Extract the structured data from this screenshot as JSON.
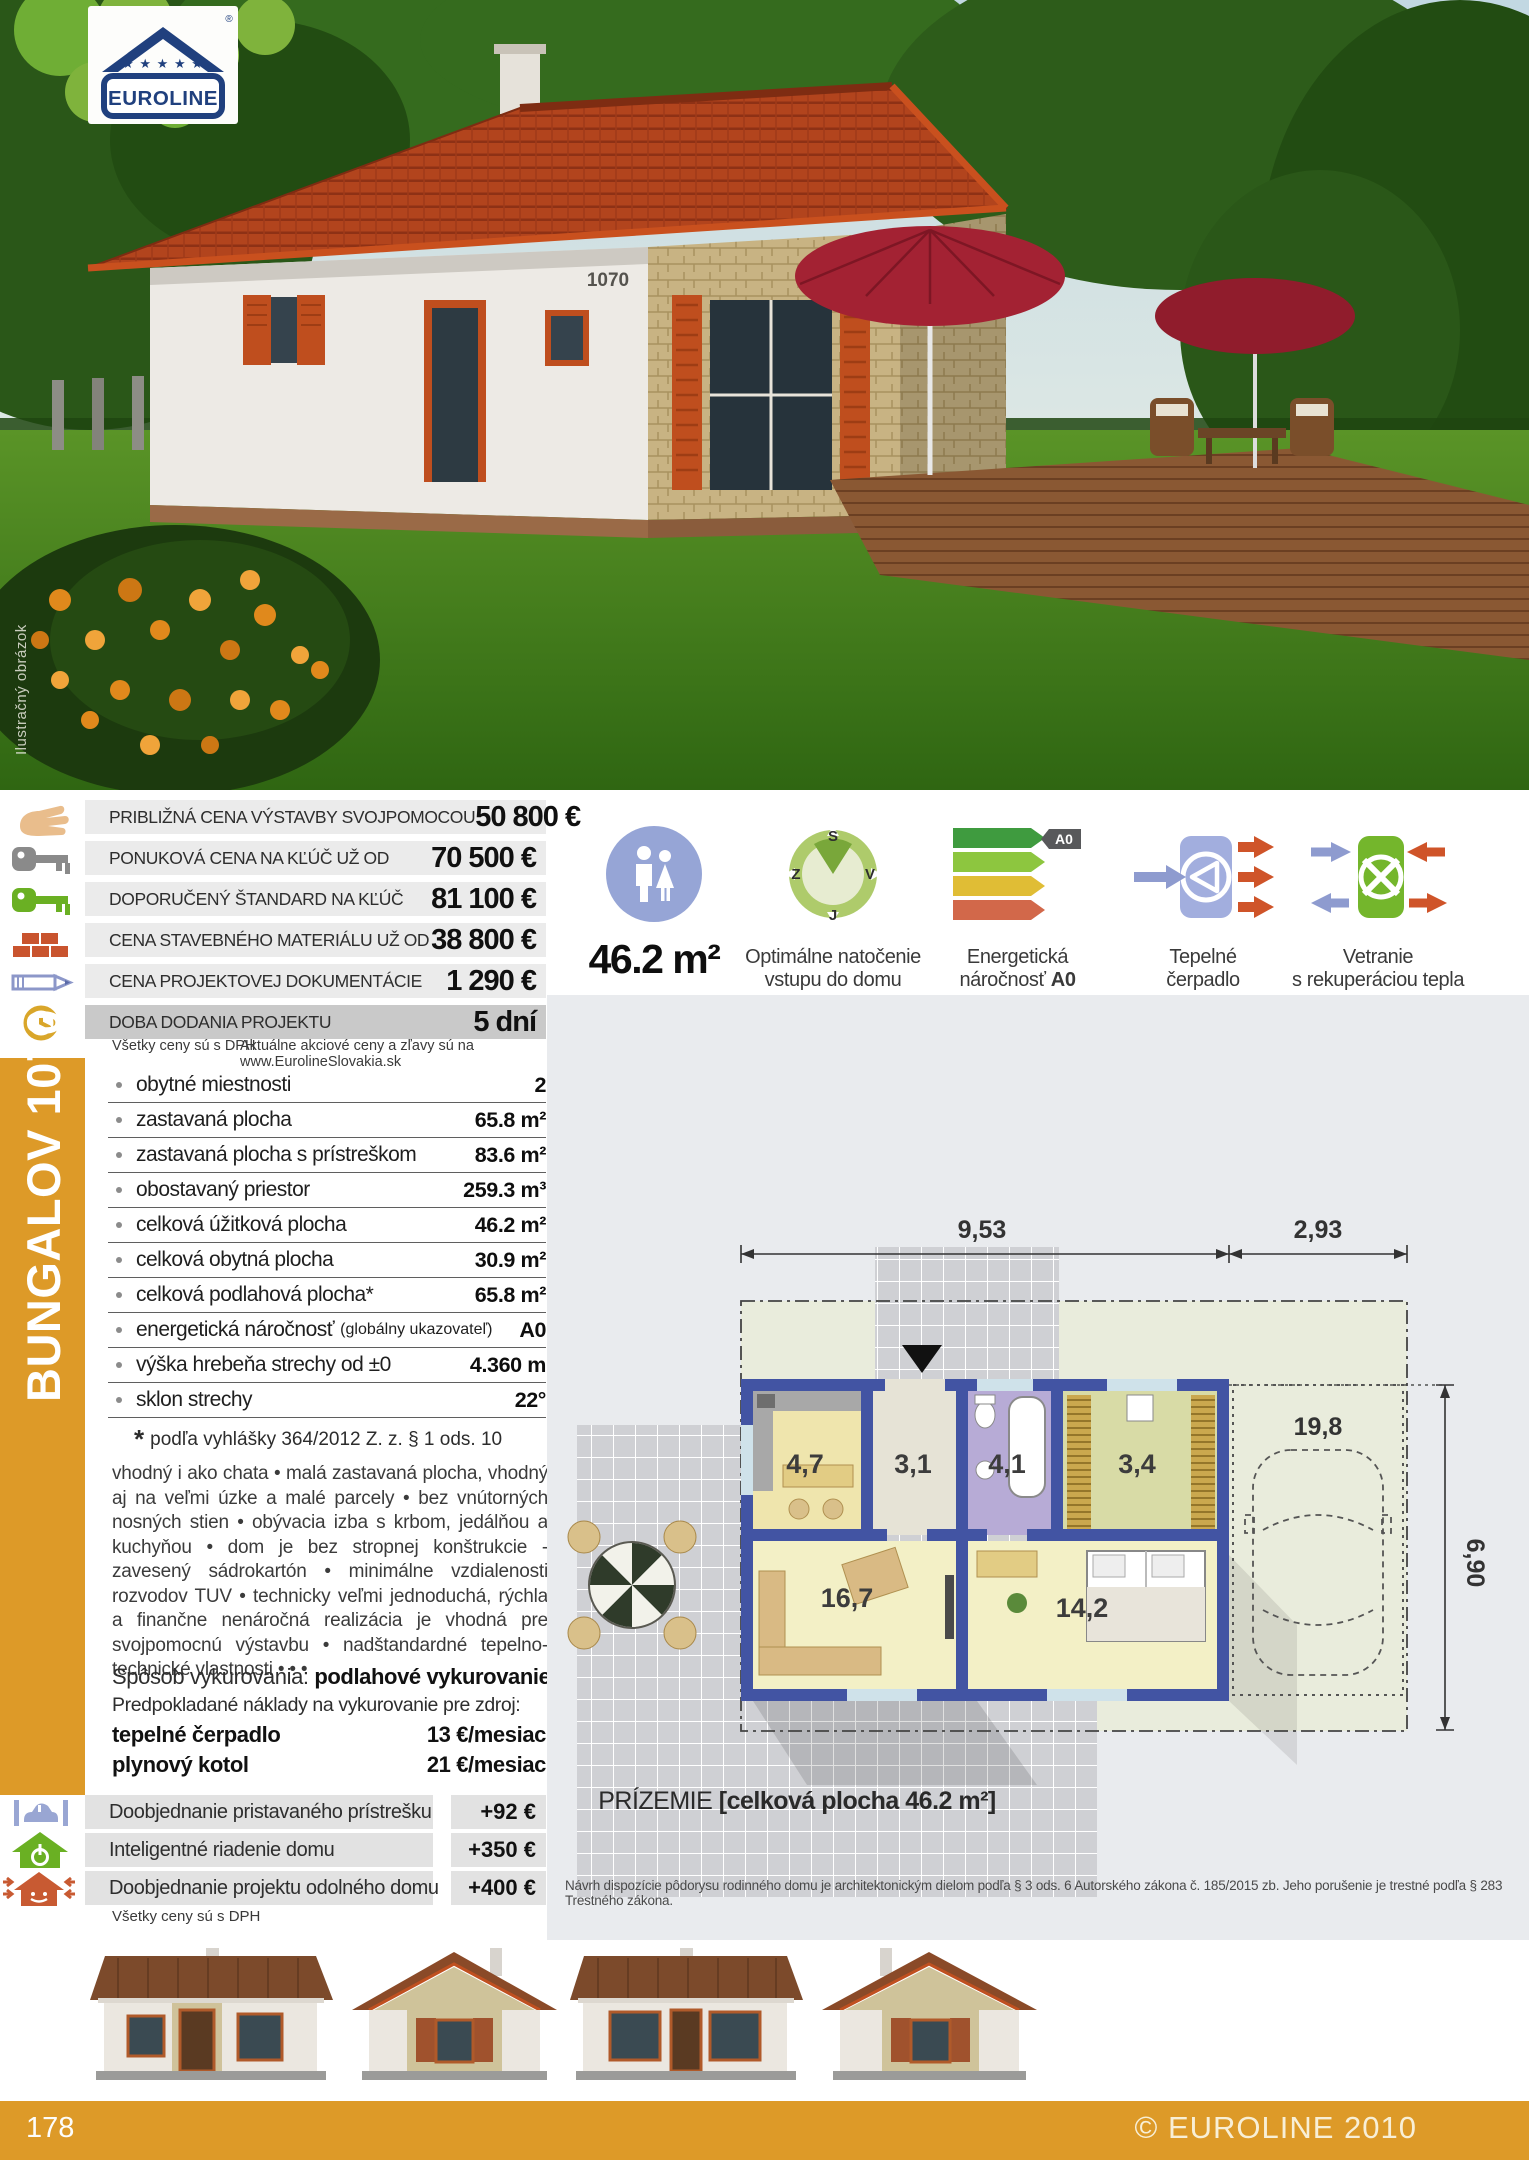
{
  "colors": {
    "accent_orange": "#DD9A28",
    "row_gray": "#EBEBEB",
    "row_dark_gray": "#C9C9C9",
    "panel_gray": "#E9EBEE",
    "energy_badge_gray": "#58595B",
    "roof_red": "#B2441D"
  },
  "logo": {
    "brand": "EUROLINE",
    "stars": "★ ★ ★ ★ ★",
    "registered": "®"
  },
  "photo": {
    "watermark": "Ilustračný obrázok",
    "house_number": "1070"
  },
  "sidebar": {
    "title": "BUNGALOV 1070"
  },
  "price_table": {
    "rows": [
      {
        "icon": "self-build-hand-icon",
        "label": "PRIBLIŽNÁ CENA VÝSTAVBY SVOJPOMOCOU",
        "value": "50 800 €"
      },
      {
        "icon": "turnkey-key-icon",
        "label": "PONUKOVÁ CENA NA KĽÚČ UŽ OD",
        "value": "70 500 €"
      },
      {
        "icon": "standard-key-icon",
        "label": "DOPORUČENÝ ŠTANDARD NA KĽÚČ",
        "value": "81 100 €"
      },
      {
        "icon": "bricks-icon",
        "label": "CENA STAVEBNÉHO MATERIÁLU UŽ OD",
        "value": "38 800 €"
      },
      {
        "icon": "pencil-icon",
        "label": "CENA PROJEKTOVEJ DOKUMENTÁCIE",
        "value": "1 290 €"
      },
      {
        "icon": "clock-icon",
        "label": "DOBA DODANIA PROJEKTU",
        "value": "5 dní"
      }
    ],
    "note_left": "Všetky ceny sú s DPH",
    "note_right": "Aktuálne akciové ceny a zľavy sú na www.EurolineSlovakia.sk"
  },
  "specs": {
    "rows": [
      {
        "label": "obytné miestnosti",
        "label_small": "",
        "value": "2"
      },
      {
        "label": "zastavaná plocha",
        "label_small": "",
        "value": "65.8 m²"
      },
      {
        "label": "zastavaná plocha s prístreškom",
        "label_small": "",
        "value": "83.6 m²"
      },
      {
        "label": "obostavaný priestor",
        "label_small": "",
        "value": "259.3 m³"
      },
      {
        "label": "celková úžitková plocha",
        "label_small": "",
        "value": "46.2 m²"
      },
      {
        "label": "celková obytná plocha",
        "label_small": "",
        "value": "30.9 m²"
      },
      {
        "label": "celková podlahová plocha*",
        "label_small": "",
        "value": "65.8 m²"
      },
      {
        "label": "energetická náročnosť",
        "label_small": "(globálny ukazovateľ)",
        "value": "A0"
      },
      {
        "label": "výška hrebeňa strechy od ±0",
        "label_small": "",
        "value": "4.360 m"
      },
      {
        "label": "sklon strechy",
        "label_small": "",
        "value": "22°"
      }
    ],
    "footnote_star": "*",
    "footnote_text": "podľa vyhlášky 364/2012 Z. z. § 1 ods. 10"
  },
  "description": {
    "text": "vhodný i ako chata • malá zastavaná plocha, vhodný aj na veľmi úzke a malé parcely • bez vnútorných nosných stien • obývacia izba s krbom, jedálňou a kuchyňou • dom je bez stropnej konštrukcie - zavesený sádrokartón • minimálne vzdialenosti rozvodov TUV • technicky veľmi jednoduchá, rýchla a finančne nenáročná realizácia je vhodná pre svojpomocnú výstavbu • nadštandardné tepelno-technické vlastnosti • • •"
  },
  "heating": {
    "line1_prefix": "Spôsob vykurovania: ",
    "line1_bold": "podlahové vykurovanie",
    "line2": "Predpokladané náklady na vykurovanie pre zdroj:",
    "rows": [
      {
        "label": "tepelné čerpadlo",
        "value": "13 €/mesiac"
      },
      {
        "label": "plynový kotol",
        "value": "21 €/mesiac"
      }
    ]
  },
  "addons": {
    "rows": [
      {
        "icon": "carport-icon",
        "label": "Doobjednanie pristavaného prístrešku",
        "value": "+92 €"
      },
      {
        "icon": "smart-home-icon",
        "label": "Inteligentné riadenie domu",
        "value": "+350 €"
      },
      {
        "icon": "resilient-house-icon",
        "label": "Doobjednanie projektu odolného domu",
        "value": "+400 €"
      }
    ],
    "note": "Všetky ceny sú s DPH"
  },
  "features": {
    "area": {
      "icon": "occupants-icon",
      "value": "46.2 m²"
    },
    "compass": {
      "caption_line1": "Optimálne natočenie",
      "caption_line2": "vstupu do domu",
      "labels": {
        "n": "S",
        "w": "Z",
        "e": "V",
        "s": "J"
      }
    },
    "energy": {
      "caption_line1": "Energetická",
      "caption_line2_prefix": "náročnosť ",
      "caption_line2_bold": "A0",
      "badge": "A0"
    },
    "heatpump": {
      "caption_line1": "Tepelné",
      "caption_line2": "čerpadlo"
    },
    "ventilation": {
      "caption_line1": "Vetranie",
      "caption_line2": "s rekuperáciou tepla"
    }
  },
  "floorplan": {
    "dims": {
      "width_main": "9,53",
      "width_carport": "2,93",
      "carport_area": "19,8",
      "depth": "6,90"
    },
    "rooms": {
      "kitchen": "4,7",
      "hall": "3,1",
      "bath": "4,1",
      "storage": "3,4",
      "living": "16,7",
      "bedroom": "14,2"
    },
    "caption_prefix": "PRÍZEMIE ",
    "caption_bold": "[celková plocha 46.2 m²]",
    "legal": "Návrh dispozície pôdorysu rodinného domu je architektonickým dielom podľa § 3 ods. 6 Autorského zákona č. 185/2015 zb. Jeho porušenie je trestné podľa § 283 Trestného zákona."
  },
  "footer": {
    "page_number": "178",
    "copyright": "© EUROLINE 2010"
  }
}
